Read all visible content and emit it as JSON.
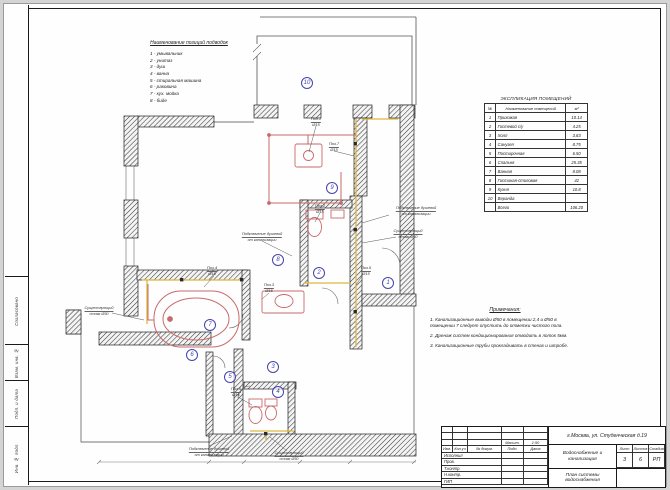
{
  "colors": {
    "pipe_supply": "#c96a6a",
    "pipe_drain": "#ddb83c",
    "room_badge": "#4343b0",
    "wall": "#1c1c1c"
  },
  "legend": {
    "title": "Наименование позиций подводок",
    "items": [
      "1 - умывальник",
      "2 - унитаз",
      "3 - душ",
      "4 - ванна",
      "5 - стиральная машина",
      "6 - раковина",
      "7 - кух. мойка",
      "8 - биде"
    ]
  },
  "explication": {
    "title": "ЭКСПЛИКАЦИЯ ПОМЕЩЕНИЙ",
    "columns": [
      "№",
      "Наименование помещений",
      "м²"
    ],
    "rows": [
      [
        "1",
        "Прихожая",
        "10.14"
      ],
      [
        "2",
        "Гостевой с/у",
        "4.25"
      ],
      [
        "3",
        "Холл",
        "3.83"
      ],
      [
        "4",
        "Санузел",
        "8.75"
      ],
      [
        "5",
        "Постирочная",
        "6.50"
      ],
      [
        "6",
        "Спальня",
        "25.35"
      ],
      [
        "7",
        "Ванная",
        "8.08"
      ],
      [
        "8",
        "Гостиная-столовая",
        "42"
      ],
      [
        "9",
        "Кухня",
        "10.8"
      ],
      [
        "10",
        "Веранда",
        ""
      ],
      [
        "",
        "Всего",
        "106.20"
      ]
    ]
  },
  "notes": {
    "title": "Примечания:",
    "items": [
      "1. Канализационные выводы Ø50 в помещении 2,4 и Ø50 в помещении 7 следует опустить до отметки чистого пола.",
      "2. Дренаж систем кондиционирования отводить в лоток 5мм.",
      "3. Канализационные трубы прокладывать в стенах и штробе."
    ]
  },
  "plan": {
    "rooms": [
      "1",
      "2",
      "3",
      "4",
      "5",
      "6",
      "7",
      "8",
      "9",
      "10"
    ],
    "callouts": [
      {
        "l1": "Поз.1",
        "l2": "Ø15"
      },
      {
        "l1": "Поз.7",
        "l2": "Ø15"
      },
      {
        "l1": "Поз.2",
        "l2": "Ø15"
      },
      {
        "l1": "Подключение душевой",
        "l2": "от канализации"
      },
      {
        "l1": "Существующий",
        "l2": "стояк Ø50"
      },
      {
        "l1": "Подключение душевой",
        "l2": "от канализации"
      },
      {
        "l1": "Существующий",
        "l2": "стояк Ø50"
      },
      {
        "l1": "Поз.4",
        "l2": "Ø15"
      },
      {
        "l1": "Поз.3",
        "l2": "Ø15"
      },
      {
        "l1": "Поз.6",
        "l2": "Ø15"
      },
      {
        "l1": "Подключение душевой",
        "l2": "от канализации"
      },
      {
        "l1": "Существующий",
        "l2": "стояк Ø50"
      },
      {
        "l1": "Поз.5",
        "l2": "Ø15"
      }
    ]
  },
  "titleblock": {
    "address": "г.Москва, ул. Студенческая д.19",
    "project": "Водоснабжение и канализация",
    "drawing_title": "План системы водоснабжения",
    "scale_label": "Масшт.",
    "scale": "1:50",
    "header": [
      "Изм.",
      "Кол.уч",
      "№ докум.",
      "Подп.",
      "Дата"
    ],
    "roles": [
      "Исполнил",
      "Пров.",
      "Т.контр.",
      "Н.контр.",
      "ГИП"
    ],
    "cols": {
      "list_label": "Лист",
      "listov_label": "Листов",
      "stage_label": "Стадия",
      "list": "3",
      "listov": "6",
      "stage": "РП"
    }
  },
  "side": {
    "items": [
      "Согласовано",
      "Взам. инв. №",
      "Подп. и дата",
      "Инв. № подл."
    ]
  }
}
